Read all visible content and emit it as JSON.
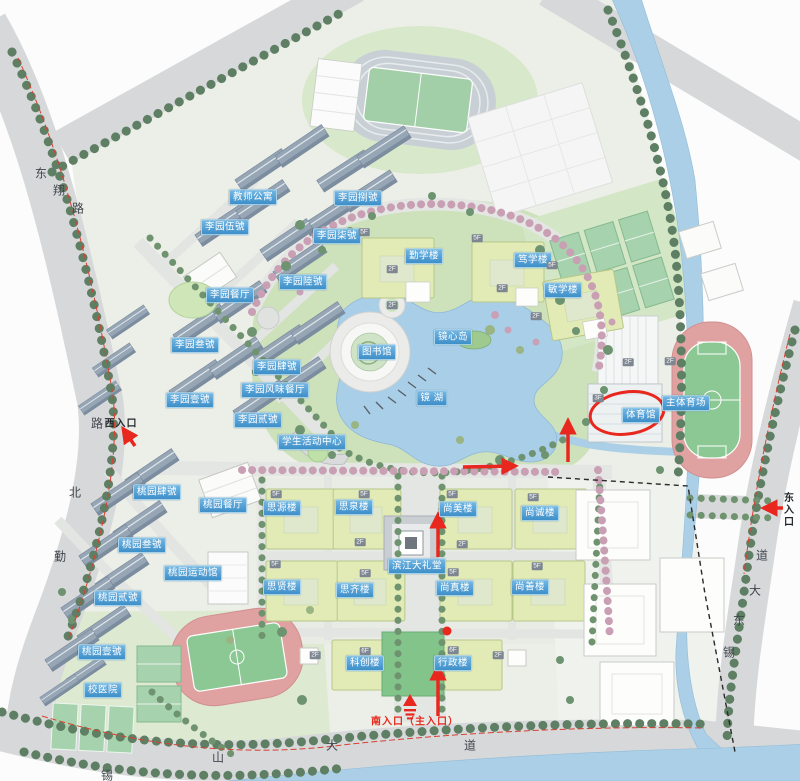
{
  "map": {
    "labels": {
      "facilities": [
        {
          "text": "教师公寓",
          "x": 253,
          "y": 197
        },
        {
          "text": "李园捌號",
          "x": 358,
          "y": 198
        },
        {
          "text": "李园伍號",
          "x": 225,
          "y": 227
        },
        {
          "text": "李园柒號",
          "x": 337,
          "y": 236
        },
        {
          "text": "李园陸號",
          "x": 303,
          "y": 282
        },
        {
          "text": "李园餐厅",
          "x": 230,
          "y": 295
        },
        {
          "text": "李园叁號",
          "x": 195,
          "y": 345
        },
        {
          "text": "李园肆號",
          "x": 277,
          "y": 367
        },
        {
          "text": "李园风味餐厅",
          "x": 275,
          "y": 390
        },
        {
          "text": "李园壹號",
          "x": 190,
          "y": 400
        },
        {
          "text": "李园贰號",
          "x": 258,
          "y": 420
        },
        {
          "text": "学生活动中心",
          "x": 312,
          "y": 442
        },
        {
          "text": "勤学楼",
          "x": 424,
          "y": 256
        },
        {
          "text": "笃学楼",
          "x": 533,
          "y": 260
        },
        {
          "text": "敏学楼",
          "x": 563,
          "y": 290
        },
        {
          "text": "图书馆",
          "x": 377,
          "y": 352
        },
        {
          "text": "镜心岛",
          "x": 453,
          "y": 337
        },
        {
          "text": "镜 湖",
          "x": 432,
          "y": 398
        },
        {
          "text": "体育馆",
          "x": 641,
          "y": 415
        },
        {
          "text": "主体育场",
          "x": 686,
          "y": 403
        },
        {
          "text": "思源楼",
          "x": 282,
          "y": 508
        },
        {
          "text": "思泉楼",
          "x": 354,
          "y": 507
        },
        {
          "text": "尚美楼",
          "x": 458,
          "y": 509
        },
        {
          "text": "尚诚楼",
          "x": 540,
          "y": 513
        },
        {
          "text": "思贤楼",
          "x": 282,
          "y": 587
        },
        {
          "text": "思齐楼",
          "x": 355,
          "y": 590
        },
        {
          "text": "尚真楼",
          "x": 455,
          "y": 588
        },
        {
          "text": "尚善楼",
          "x": 530,
          "y": 587
        },
        {
          "text": "滨江大礼堂",
          "x": 417,
          "y": 566
        },
        {
          "text": "桃园肆號",
          "x": 157,
          "y": 492
        },
        {
          "text": "桃园餐厅",
          "x": 223,
          "y": 505
        },
        {
          "text": "桃园叁號",
          "x": 142,
          "y": 545
        },
        {
          "text": "桃园运动馆",
          "x": 193,
          "y": 573
        },
        {
          "text": "桃园贰號",
          "x": 118,
          "y": 598
        },
        {
          "text": "桃园壹號",
          "x": 102,
          "y": 652
        },
        {
          "text": "校医院",
          "x": 103,
          "y": 690
        },
        {
          "text": "科创楼",
          "x": 365,
          "y": 663
        },
        {
          "text": "行政楼",
          "x": 453,
          "y": 663
        }
      ],
      "road_chars": [
        {
          "text": "东",
          "x": 41,
          "y": 173
        },
        {
          "text": "翔",
          "x": 59,
          "y": 190
        },
        {
          "text": "路",
          "x": 78,
          "y": 208
        },
        {
          "text": "路",
          "x": 97,
          "y": 423
        },
        {
          "text": "北",
          "x": 75,
          "y": 492
        },
        {
          "text": "勤",
          "x": 60,
          "y": 556
        },
        {
          "text": "锡",
          "x": 107,
          "y": 775
        },
        {
          "text": "山",
          "x": 218,
          "y": 757
        },
        {
          "text": "大",
          "x": 332,
          "y": 745
        },
        {
          "text": "道",
          "x": 470,
          "y": 745
        },
        {
          "text": "道",
          "x": 762,
          "y": 555
        },
        {
          "text": "大",
          "x": 755,
          "y": 590
        },
        {
          "text": "东",
          "x": 739,
          "y": 620
        },
        {
          "text": "锡",
          "x": 729,
          "y": 652
        }
      ],
      "entrances": [
        {
          "text": "西入口",
          "x": 121,
          "y": 422,
          "style": "black"
        },
        {
          "text": "东入口",
          "x": 787,
          "y": 510,
          "style": "black-vertical"
        },
        {
          "text": "南入口（主入口）",
          "x": 415,
          "y": 720,
          "style": "red"
        }
      ],
      "floor_tags": [
        {
          "text": "5F",
          "x": 364,
          "y": 232
        },
        {
          "text": "2F",
          "x": 392,
          "y": 269
        },
        {
          "text": "5F",
          "x": 477,
          "y": 238
        },
        {
          "text": "2F",
          "x": 502,
          "y": 288
        },
        {
          "text": "5F",
          "x": 552,
          "y": 265
        },
        {
          "text": "2F",
          "x": 536,
          "y": 316
        },
        {
          "text": "2F",
          "x": 392,
          "y": 305
        },
        {
          "text": "5F",
          "x": 276,
          "y": 494
        },
        {
          "text": "5F",
          "x": 364,
          "y": 494
        },
        {
          "text": "5F",
          "x": 452,
          "y": 494
        },
        {
          "text": "5F",
          "x": 533,
          "y": 497
        },
        {
          "text": "5F",
          "x": 275,
          "y": 564
        },
        {
          "text": "5F",
          "x": 365,
          "y": 573
        },
        {
          "text": "5F",
          "x": 453,
          "y": 572
        },
        {
          "text": "5F",
          "x": 537,
          "y": 566
        },
        {
          "text": "2F",
          "x": 360,
          "y": 542
        },
        {
          "text": "2F",
          "x": 462,
          "y": 544
        },
        {
          "text": "6F",
          "x": 365,
          "y": 651
        },
        {
          "text": "2F",
          "x": 315,
          "y": 655
        },
        {
          "text": "6F",
          "x": 453,
          "y": 650
        },
        {
          "text": "2F",
          "x": 498,
          "y": 655
        },
        {
          "text": "3F",
          "x": 598,
          "y": 398
        },
        {
          "text": "2F",
          "x": 628,
          "y": 362
        },
        {
          "text": "2F",
          "x": 670,
          "y": 361
        }
      ]
    },
    "annotations": {
      "highlight_ellipse": {
        "cx": 627,
        "cy": 413,
        "rx": 37,
        "ry": 21,
        "rotate": -8
      },
      "route_dot": {
        "cx": 447,
        "cy": 631,
        "r": 4.5
      },
      "arrows": [
        {
          "x1": 463,
          "y1": 467,
          "x2": 514,
          "y2": 466
        },
        {
          "x1": 568,
          "y1": 462,
          "x2": 568,
          "y2": 422
        },
        {
          "x1": 438,
          "y1": 557,
          "x2": 438,
          "y2": 516
        },
        {
          "x1": 438,
          "y1": 716,
          "x2": 438,
          "y2": 668
        },
        {
          "x1": 135,
          "y1": 446,
          "x2": 124,
          "y2": 430
        },
        {
          "x1": 783,
          "y1": 508,
          "x2": 765,
          "y2": 508
        }
      ],
      "south_gate_symbol": {
        "x": 410,
        "y": 702
      }
    },
    "colors": {
      "label_blue": "#3d8ec9",
      "annotation_red": "#e8281e",
      "lake_blue": "#a9cee7",
      "road_gray": "#d6d8da",
      "building_green": "#e2ebb6"
    }
  }
}
